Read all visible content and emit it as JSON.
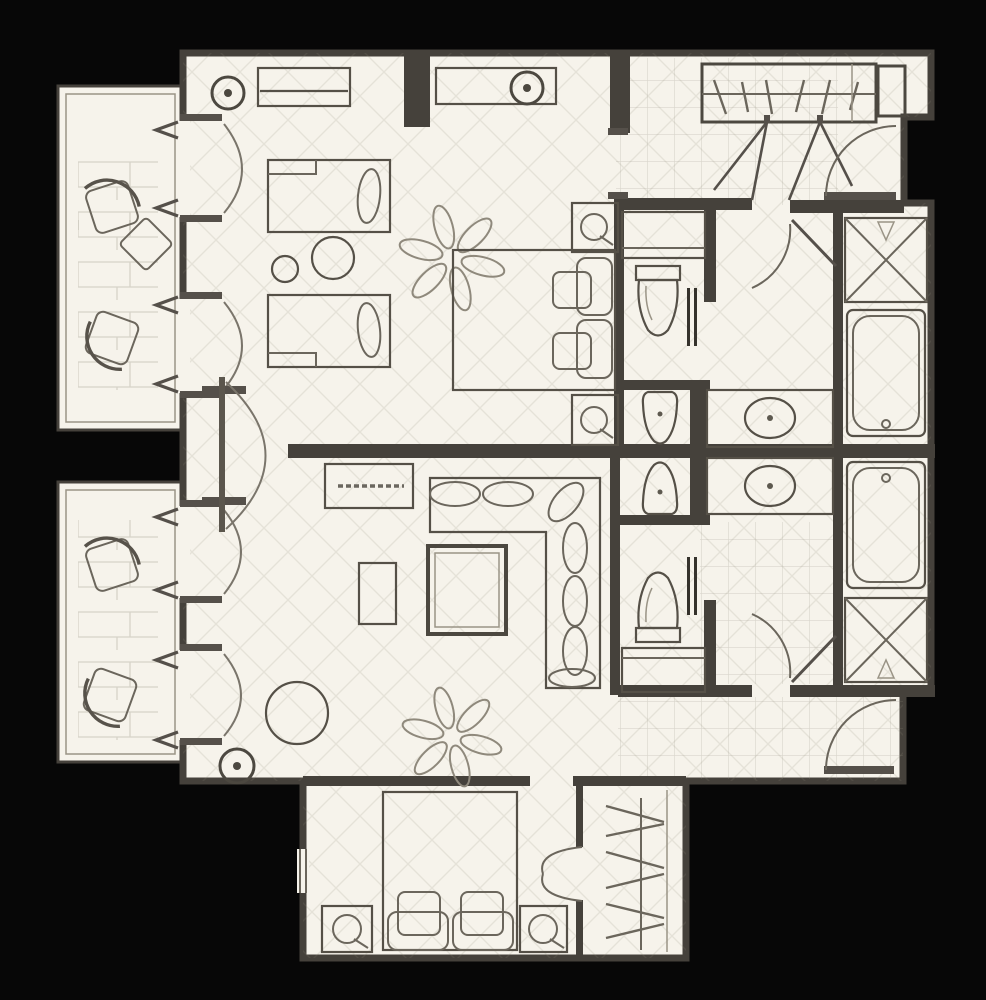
{
  "title": "Two-bedroom suite floor plan",
  "colors": {
    "background": "#070707",
    "floor": "#f6f3eb",
    "wall": "#45413b",
    "furniture_line": "#5b564d",
    "faint_line": "#9a9486"
  },
  "rooms": {
    "bedroom1": {
      "name": "Bedroom 1",
      "features": [
        "twin bed",
        "twin bed",
        "round table",
        "stool",
        "king bed",
        "nightstand with lamp",
        "nightstand with lamp",
        "dresser",
        "credenza",
        "ceiling fan",
        "ceiling light",
        "ceiling light",
        "balcony doors"
      ]
    },
    "bedroom2": {
      "name": "Bedroom 2",
      "features": [
        "king bed",
        "nightstand with lamp",
        "nightstand with lamp",
        "closet with hangers",
        "window"
      ]
    },
    "living": {
      "name": "Living Room",
      "features": [
        "sectional sofa",
        "coffee table",
        "side table",
        "console table",
        "round pouf",
        "ceiling fan",
        "ceiling light",
        "balcony doors",
        "pivot door"
      ]
    },
    "entry": {
      "name": "Entry Hall",
      "features": [
        "entry door",
        "closet with hangers",
        "tile floor",
        "service shaft"
      ]
    },
    "bath1": {
      "name": "Bathroom 1",
      "features": [
        "toilet",
        "bidet",
        "sink counter",
        "bathtub",
        "shower",
        "pocket door",
        "cabinet"
      ]
    },
    "bath2": {
      "name": "Bathroom 2",
      "features": [
        "toilet",
        "bidet",
        "sink counter",
        "bathtub",
        "shower",
        "pocket door",
        "cabinet"
      ]
    },
    "hall": {
      "name": "Rear Hallway",
      "features": [
        "exit door",
        "tile floor"
      ]
    },
    "balcony1": {
      "name": "Balcony 1",
      "features": [
        "lounge chair",
        "lounge chair",
        "side table",
        "tile floor"
      ]
    },
    "balcony2": {
      "name": "Balcony 2",
      "features": [
        "lounge chair",
        "lounge chair",
        "tile floor"
      ]
    }
  },
  "counts": {
    "bedrooms": 2,
    "bathrooms": 2,
    "balconies": 2,
    "beds": 4,
    "lounge_chairs": 4,
    "ceiling_fans": 2,
    "bathtubs": 2,
    "showers": 2,
    "toilets": 2,
    "bidets": 2,
    "sinks": 2,
    "closets": 2,
    "entry_doors": 2
  }
}
